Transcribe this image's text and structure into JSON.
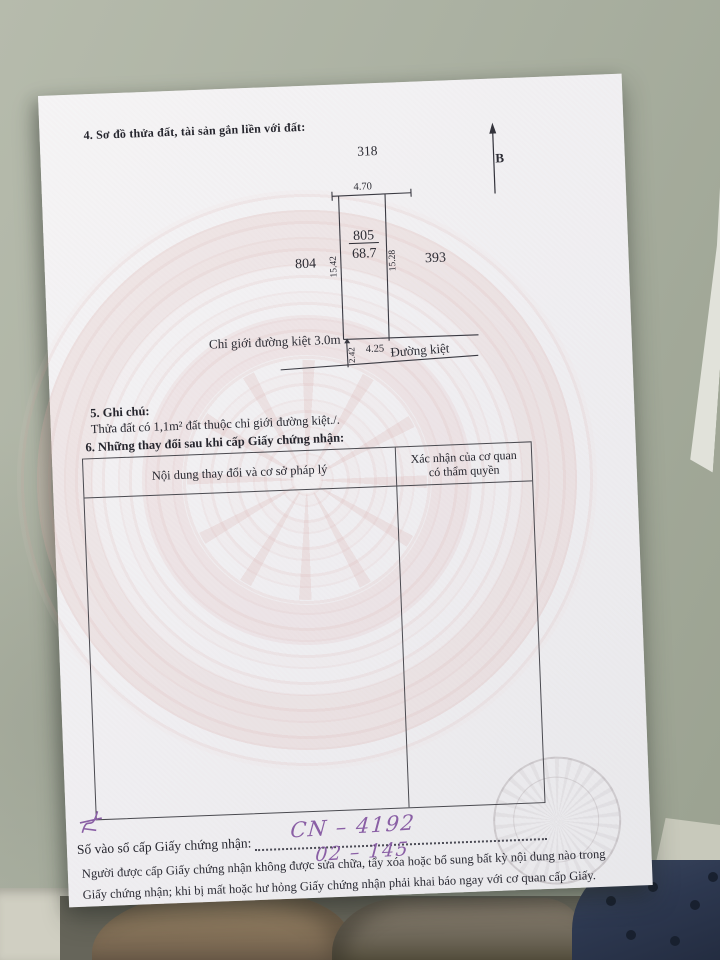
{
  "photo": {
    "scene_description": "land-use certificate page lying on floor",
    "colors": {
      "floor": "#a8ae9f",
      "paper": "#f1f0f2",
      "watermark_pink": "#dbacA9",
      "ink": "#26262e",
      "handwriting_ink": "#8a5fa5"
    }
  },
  "document": {
    "section4": {
      "heading": "4. Sơ đồ thửa đất, tài sản gắn liền với đất:"
    },
    "diagram": {
      "north_label": "B",
      "parcel_top": "318",
      "parcel_left": "804",
      "parcel_right": "393",
      "parcel_number": "805",
      "parcel_area": "68.7",
      "dim_top": "4.70",
      "dim_left": "15.42",
      "dim_right": "15.28",
      "dim_frontage": "4.25",
      "dim_setback": "2.42",
      "boundary_label": "Chỉ giới đường kiệt 3.0m",
      "road_label": "Đường kiệt"
    },
    "section5": {
      "heading": "5. Ghi chú:",
      "note": "Thửa đất có 1,1m² đất thuộc chỉ giới đường kiệt./."
    },
    "section6": {
      "heading": "6. Những thay đổi sau khi cấp Giấy chứng nhận:",
      "table": {
        "col1": "Nội dung thay đổi và cơ sở pháp lý",
        "col2_line1": "Xác nhận của cơ quan",
        "col2_line2": "có thẩm quyền"
      }
    },
    "footer": {
      "serial_label": "Số vào sổ cấp Giấy chứng nhận:",
      "hand_serial1": "CN – 4192",
      "hand_serial2": "02 – 145",
      "notice_line1": "Người được cấp Giấy chứng nhận không được sửa chữa, tẩy xóa hoặc bổ sung bất kỳ nội dung nào trong",
      "notice_line2": "Giấy chứng nhận; khi bị mất hoặc hư hỏng Giấy chứng nhận phải khai báo ngay với cơ quan cấp Giấy."
    }
  }
}
